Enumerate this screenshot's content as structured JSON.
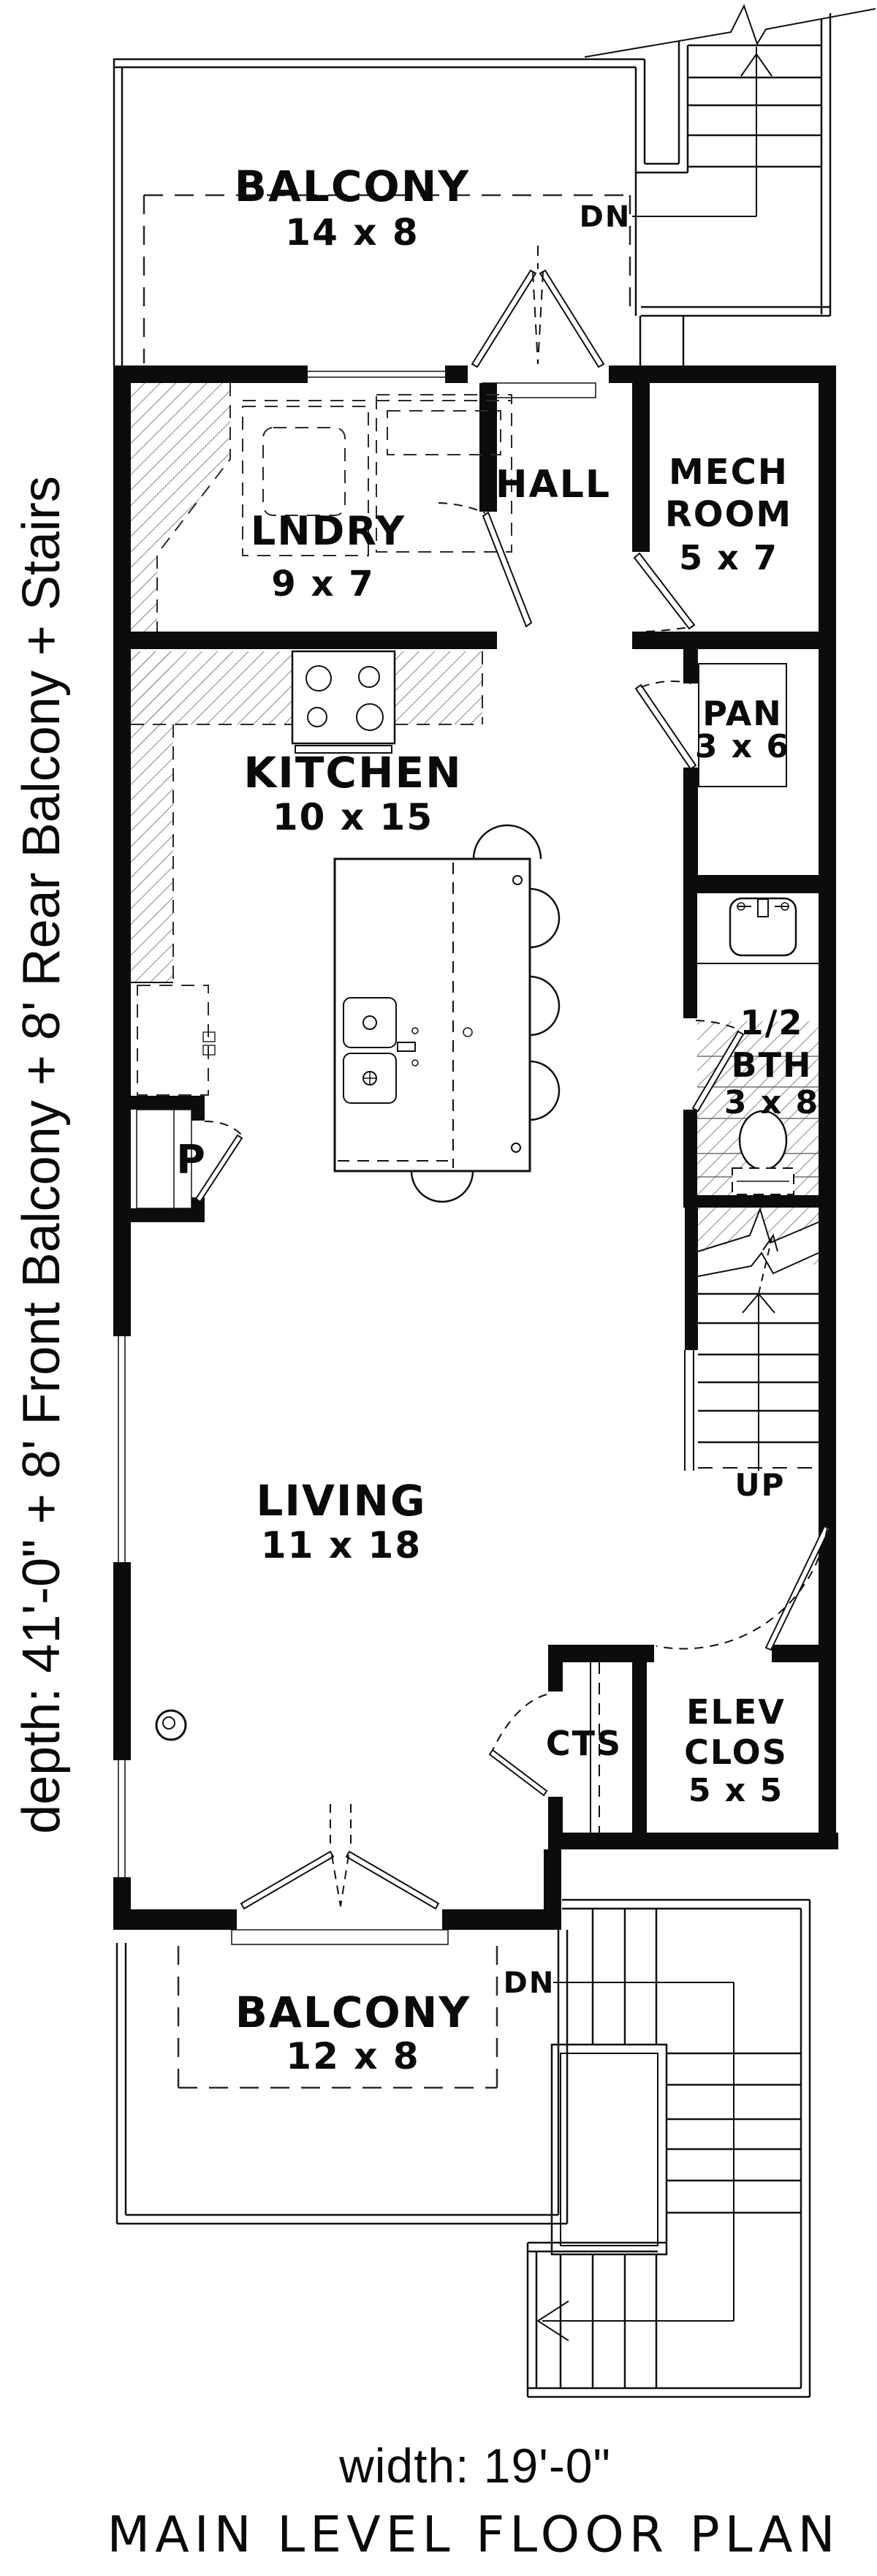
{
  "plan": {
    "title": "MAIN LEVEL FLOOR PLAN",
    "width_label": "width: 19'-0\"",
    "depth_label": "depth: 41'-0\" + 8' Front Balcony + 8' Rear Balcony + Stairs"
  },
  "rooms": {
    "balcony_rear": {
      "name": "BALCONY",
      "size": "14 x 8"
    },
    "laundry": {
      "name": "LNDRY",
      "size": "9 x 7"
    },
    "hall": {
      "name": "HALL"
    },
    "mech": {
      "line1": "MECH",
      "line2": "ROOM",
      "size": "5 x 7"
    },
    "kitchen": {
      "name": "KITCHEN",
      "size": "10 x 15"
    },
    "pantry": {
      "name": "PAN",
      "size": "3 x 6"
    },
    "half_bath": {
      "line1": "1/2",
      "line2": "BTH",
      "size": "3 x 8"
    },
    "living": {
      "name": "LIVING",
      "size": "11 x 18"
    },
    "coats_closet": {
      "name": "CTS"
    },
    "elevator_closet": {
      "line1": "ELEV",
      "line2": "CLOS",
      "size": "5 x 5"
    },
    "balcony_front": {
      "name": "BALCONY",
      "size": "12 x 8"
    },
    "pantry_closet": {
      "name": "P"
    }
  },
  "stairs": {
    "rear_down_label": "DN",
    "front_down_label": "DN",
    "up_label": "UP"
  },
  "symbols": {
    "stove": "stove-icon",
    "island_sink": "double-sink-icon",
    "vanity_sink": "vanity-sink-icon",
    "toilet": "toilet-icon",
    "washer_dryer": "washer-dryer-icon",
    "refrigerator": "refrigerator-icon",
    "outlet": "outlet-icon",
    "doors": "door-swing-icon"
  },
  "colors": {
    "ink": "#0a0a0a",
    "paper": "#ffffff",
    "hatch": "#8f8f8f"
  }
}
